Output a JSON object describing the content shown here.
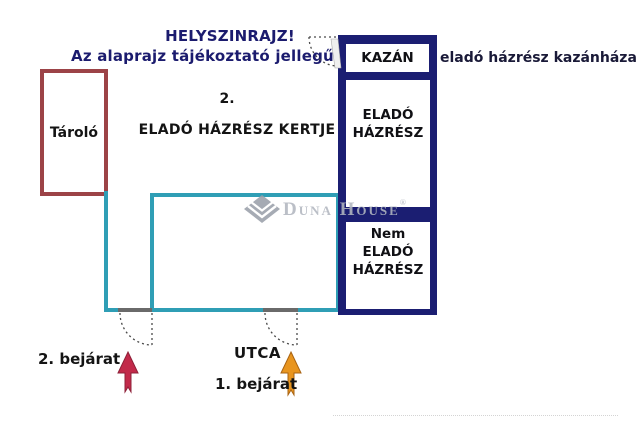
{
  "header": {
    "line1": "HELYSZINRAJZ!",
    "line2": "Az alaprajz tájékoztató jellegű!"
  },
  "plan": {
    "storage_label": "Tároló",
    "zone2": {
      "number": "2.",
      "label": "ELADÓ HÁZRÉSZ KERTJE"
    },
    "zone1": {
      "number": "1.",
      "line1": "nem eladó",
      "line2": "házrész kertje"
    },
    "column": {
      "kazan": "KAZÁN",
      "elado_line1": "ELADÓ",
      "elado_line2": "HÁZRÉSZ",
      "nem_line1": "Nem",
      "nem_line2": "ELADÓ",
      "nem_line3": "HÁZRÉSZ"
    },
    "kazan_note": "eladó házrész kazánháza"
  },
  "bottom": {
    "entrance2": "2. bejárat",
    "street": "UTCA",
    "entrance1": "1. bejárat"
  },
  "watermark": {
    "brand": "Duna House",
    "registered": "®"
  },
  "colors": {
    "navy_fill": "#1b1e72",
    "teal": "#2f9eb5",
    "storage_red": "#9c4347",
    "title_navy": "#1b1b6e",
    "arrow_crimson": "#c22a4a",
    "arrow_orange": "#e8951f",
    "door_gray": "#6a6a6a",
    "watermark_gray": "#b2b7c0"
  }
}
